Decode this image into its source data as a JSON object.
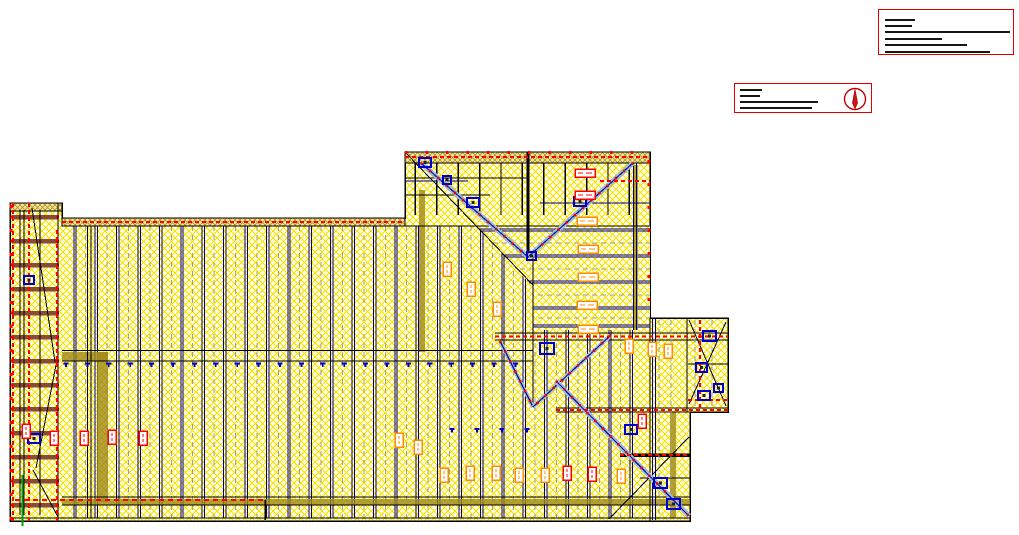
{
  "page": {
    "width": 1019,
    "height": 535,
    "background": "#ffffff"
  },
  "title_block_primary": {
    "x": 878,
    "y": 9,
    "w": 136,
    "h": 46,
    "border_color": "#e00000",
    "note": "greeked-illegible-text",
    "text_lines": [
      {
        "top": 9,
        "left": 6,
        "width": 30
      },
      {
        "top": 14.5,
        "left": 6,
        "width": 27
      },
      {
        "top": 20.5,
        "left": 6,
        "width": 125
      },
      {
        "top": 27.5,
        "left": 6,
        "width": 57
      },
      {
        "top": 34,
        "left": 6,
        "width": 82
      },
      {
        "top": 40.5,
        "left": 6,
        "width": 105
      }
    ]
  },
  "title_block_secondary": {
    "x": 734,
    "y": 83,
    "w": 138,
    "h": 30,
    "border_color": "#e00000",
    "note": "greeked-illegible-text",
    "text_lines": [
      {
        "top": 5,
        "left": 5,
        "width": 22
      },
      {
        "top": 10.5,
        "left": 5,
        "width": 20
      },
      {
        "top": 16.5,
        "left": 5,
        "width": 78
      },
      {
        "top": 22.5,
        "left": 5,
        "width": 72
      }
    ],
    "north_arrow": {
      "color": "#c00000",
      "r": 10.5
    }
  },
  "drawing": {
    "colors": {
      "hatch_line": "#f5e400",
      "hatch_bg": "#fffceb",
      "band_line": "#bfa133",
      "band_bg": "#f3e9a8",
      "outline": "#000000",
      "joist": "#00008b",
      "gray_dash": "#9e9e9e",
      "beam_brown": "#8a4a38",
      "olive": "#a08818",
      "red": "#ff0000",
      "orange": "#ff8c00",
      "blue": "#0000cd",
      "hip_fill": "#9db8d8",
      "green": "#00a000"
    },
    "outline_polygon": "10,203 62,203 62,218 405,218 405,152 650,152 650,318 728,318 728,412 690,412 690,521 10,521",
    "bands": [
      {
        "x": 10,
        "y": 203,
        "w": 52,
        "h": 8
      },
      {
        "x": 62,
        "y": 218,
        "w": 343,
        "h": 8
      },
      {
        "x": 405,
        "y": 152,
        "w": 245,
        "h": 11
      }
    ],
    "vjoists": {
      "x0": 75,
      "step": 21.4,
      "count": 27,
      "y1": 226,
      "y2": 518
    },
    "hjoists": {
      "ys": [
        230,
        256,
        282,
        308,
        326
      ],
      "gray_ys": [
        243,
        269,
        295,
        318
      ],
      "x1": 430,
      "x2": 650,
      "clip_polygon": "476,226 650,226 650,330 533,330 533,287"
    },
    "studs": {
      "x0": 415.4,
      "step": 21.4,
      "count": 11,
      "y1": 163,
      "y2": 215
    },
    "strip": {
      "x": 10,
      "w": 52,
      "beam_x": 12,
      "beam_w": 46,
      "beam_h": 4.5,
      "beams_y0": 215,
      "beams_step": 24,
      "beams_count": 13
    },
    "olive_bars": [
      [
        62,
        352,
        46,
        9
      ],
      [
        97,
        352,
        11,
        150
      ],
      [
        419,
        190,
        6,
        162
      ],
      [
        633,
        165,
        5,
        165
      ],
      [
        670,
        412,
        6,
        106
      ],
      [
        62,
        499,
        628,
        6
      ]
    ],
    "black_lines": [
      [
        62,
        226,
        650,
        226,
        1
      ],
      [
        405,
        163,
        650,
        163,
        1.2
      ],
      [
        528,
        152,
        528,
        258,
        3
      ],
      [
        495,
        333,
        728,
        333,
        1.3
      ],
      [
        495,
        340,
        728,
        340,
        1.3
      ],
      [
        62,
        350.5,
        533,
        350.5,
        1.2
      ],
      [
        62,
        361,
        533,
        361,
        1.2
      ],
      [
        87.5,
        226,
        87.5,
        518,
        0.8
      ],
      [
        91,
        226,
        91,
        518,
        0.8
      ],
      [
        62,
        497,
        690,
        497,
        1
      ],
      [
        62,
        505,
        690,
        505,
        1
      ],
      [
        10,
        518,
        690,
        518,
        1.3
      ],
      [
        650,
        318,
        650,
        521,
        1.3
      ],
      [
        687,
        318,
        687,
        412,
        1.2
      ],
      [
        556,
        408,
        728,
        408,
        1.2
      ],
      [
        556,
        412,
        728,
        412,
        1.2
      ],
      [
        620,
        455,
        690,
        455,
        3.5
      ],
      [
        640,
        478,
        690,
        478,
        1
      ],
      [
        688,
        364,
        728,
        364,
        1
      ],
      [
        58,
        203,
        58,
        521,
        1
      ],
      [
        20,
        210,
        20,
        515,
        0.8
      ],
      [
        24,
        210,
        24,
        515,
        0.8
      ],
      [
        40,
        210,
        40,
        515,
        0.8
      ],
      [
        265,
        500,
        265,
        520,
        1.5
      ],
      [
        405,
        195,
        490,
        195,
        1
      ],
      [
        405,
        178,
        527,
        178,
        1
      ]
    ],
    "navy_lines": [
      [
        652.5,
        318,
        652.5,
        520
      ],
      [
        655.5,
        318,
        655.5,
        520
      ],
      [
        633.5,
        163,
        633.5,
        330
      ],
      [
        636.5,
        163,
        636.5,
        330
      ],
      [
        540,
        203,
        650,
        203
      ],
      [
        405,
        181,
        468,
        181
      ]
    ],
    "gray_dashed_extra": [
      [
        659,
        320,
        659,
        516
      ],
      [
        671,
        320,
        671,
        516
      ],
      [
        695,
        320,
        695,
        410
      ],
      [
        712,
        320,
        712,
        410
      ]
    ],
    "thin_diagonals": [
      [
        405,
        152,
        533,
        285
      ],
      [
        609,
        519,
        689,
        437
      ],
      [
        689,
        320,
        726,
        406
      ],
      [
        726,
        322,
        689,
        404
      ],
      [
        32,
        208,
        55,
        362
      ],
      [
        56,
        365,
        36,
        468
      ],
      [
        33,
        470,
        58,
        517
      ]
    ],
    "ridge_line": [
      533,
      258,
      533,
      407
    ],
    "hips": [
      [
        421,
        163,
        528,
        257,
        5
      ],
      [
        633,
        163,
        528,
        257,
        5
      ],
      [
        500,
        341,
        533,
        407,
        4
      ],
      [
        611,
        335,
        533,
        407,
        4
      ],
      [
        556,
        381,
        689,
        516,
        5
      ]
    ],
    "red_dashed": [
      [
        62,
        222,
        405,
        222
      ],
      [
        405,
        157,
        650,
        157
      ],
      [
        600,
        181,
        650,
        181
      ],
      [
        495,
        336.5,
        728,
        336.5
      ],
      [
        556,
        410,
        728,
        410
      ],
      [
        620,
        455,
        690,
        455
      ],
      [
        15,
        500,
        265,
        500,
        2,
        "5 4"
      ],
      [
        13,
        203,
        13,
        521
      ],
      [
        29,
        203,
        29,
        521
      ],
      [
        57,
        230,
        57,
        521
      ],
      [
        700,
        320,
        700,
        410
      ],
      [
        688,
        400,
        728,
        400
      ],
      [
        405,
        152.5,
        650,
        152.5,
        3,
        "2.5 18"
      ],
      [
        11,
        205,
        11,
        520,
        3,
        "3 21"
      ],
      [
        649,
        160,
        649,
        316,
        3,
        "3 20"
      ]
    ],
    "marker_rows": [
      {
        "y": 362.5,
        "xs0": 66,
        "step": 21.4,
        "count": 22
      },
      {
        "y": 428,
        "xs": [
          452,
          477,
          502,
          527
        ]
      }
    ],
    "blue_squares": [
      [
        419,
        158,
        12,
        9
      ],
      [
        443,
        176,
        8,
        8
      ],
      [
        467,
        198,
        12,
        9
      ],
      [
        574,
        197,
        12,
        9
      ],
      [
        527,
        252,
        9,
        8
      ],
      [
        540,
        343,
        14,
        11
      ],
      [
        625,
        425,
        12,
        9
      ],
      [
        654,
        478,
        13,
        10
      ],
      [
        667,
        499,
        13,
        10
      ],
      [
        703,
        331,
        13,
        10
      ],
      [
        696,
        363,
        11,
        9
      ],
      [
        698,
        391,
        12,
        9
      ],
      [
        714,
        384,
        9,
        8
      ],
      [
        24,
        276,
        10,
        8
      ],
      [
        28,
        434,
        12,
        9
      ]
    ],
    "label_boxes": [
      {
        "x": 22,
        "y": 424,
        "o": "v",
        "c": "red"
      },
      {
        "x": 50,
        "y": 431,
        "o": "v",
        "c": "red"
      },
      {
        "x": 80,
        "y": 431,
        "o": "v",
        "c": "red"
      },
      {
        "x": 108,
        "y": 430,
        "o": "v",
        "c": "red"
      },
      {
        "x": 139,
        "y": 431,
        "o": "v",
        "c": "red"
      },
      {
        "x": 563,
        "y": 466,
        "o": "v",
        "c": "red"
      },
      {
        "x": 588,
        "y": 467,
        "o": "v",
        "c": "red"
      },
      {
        "x": 638,
        "y": 414,
        "o": "v",
        "c": "red"
      },
      {
        "x": 395,
        "y": 433,
        "o": "v",
        "c": "orange"
      },
      {
        "x": 414,
        "y": 440,
        "o": "v",
        "c": "orange"
      },
      {
        "x": 440,
        "y": 468,
        "o": "v",
        "c": "orange"
      },
      {
        "x": 466,
        "y": 466,
        "o": "v",
        "c": "orange"
      },
      {
        "x": 492,
        "y": 466,
        "o": "v",
        "c": "orange"
      },
      {
        "x": 515,
        "y": 468,
        "o": "v",
        "c": "orange"
      },
      {
        "x": 541,
        "y": 468,
        "o": "v",
        "c": "orange"
      },
      {
        "x": 617,
        "y": 469,
        "o": "v",
        "c": "orange"
      },
      {
        "x": 443,
        "y": 262,
        "o": "v",
        "c": "orange"
      },
      {
        "x": 467,
        "y": 282,
        "o": "v",
        "c": "orange"
      },
      {
        "x": 493,
        "y": 302,
        "o": "v",
        "c": "orange"
      },
      {
        "x": 625,
        "y": 339,
        "o": "v",
        "c": "orange"
      },
      {
        "x": 648,
        "y": 342,
        "o": "v",
        "c": "orange"
      },
      {
        "x": 664,
        "y": 344,
        "o": "v",
        "c": "orange"
      },
      {
        "x": 577,
        "y": 217,
        "o": "h",
        "c": "orange"
      },
      {
        "x": 578,
        "y": 245,
        "o": "h",
        "c": "orange"
      },
      {
        "x": 578,
        "y": 273,
        "o": "h",
        "c": "orange"
      },
      {
        "x": 577,
        "y": 301,
        "o": "h",
        "c": "orange"
      },
      {
        "x": 578,
        "y": 325,
        "o": "h",
        "c": "orange"
      },
      {
        "x": 575,
        "y": 169,
        "o": "h",
        "c": "red"
      },
      {
        "x": 575,
        "y": 191,
        "o": "h",
        "c": "red"
      }
    ],
    "green_line": [
      22.5,
      475,
      22.5,
      526
    ]
  }
}
